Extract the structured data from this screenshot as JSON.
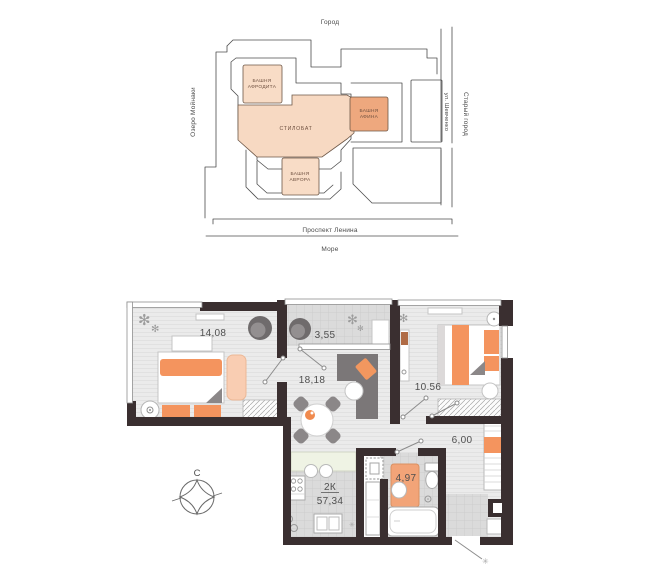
{
  "site_map": {
    "labels": {
      "city": "Город",
      "lake": "Озеро Мойнаки",
      "street": "ул. Шевченко",
      "old_town": "Старый город",
      "avenue": "Проспект Ленина",
      "sea": "Море"
    },
    "buildings": [
      {
        "id": "afrodita",
        "lines": [
          "БАШНЯ",
          "АФРОДИТА"
        ],
        "color": "#f8dcc6"
      },
      {
        "id": "stylobate",
        "lines": [
          "СТИЛОБАТ"
        ],
        "color": "#f7d9c2"
      },
      {
        "id": "afina",
        "lines": [
          "БАШНЯ",
          "АФИНА"
        ],
        "color": "#eea87e"
      },
      {
        "id": "avrora",
        "lines": [
          "БАШНЯ",
          "АВРОРА"
        ],
        "color": "#f8dcc6"
      }
    ]
  },
  "floor_plan": {
    "apartment_type": "2К",
    "total_area": "57,34",
    "compass_north": "С",
    "rooms": [
      {
        "id": "bedroom-1",
        "area": "14,08"
      },
      {
        "id": "loggia",
        "area": "3,55"
      },
      {
        "id": "living-room",
        "area": "18,18"
      },
      {
        "id": "bedroom-2",
        "area": "10.56"
      },
      {
        "id": "hallway",
        "area": "6,00"
      },
      {
        "id": "bathroom",
        "area": "4,97"
      }
    ],
    "colors": {
      "wall": "#3a2f30",
      "accent_orange": "#f4945e",
      "accent_peach": "#f9cdb2"
    }
  },
  "icons": {
    "plant_glyph": "✻",
    "asterisk_glyph": "✳"
  }
}
